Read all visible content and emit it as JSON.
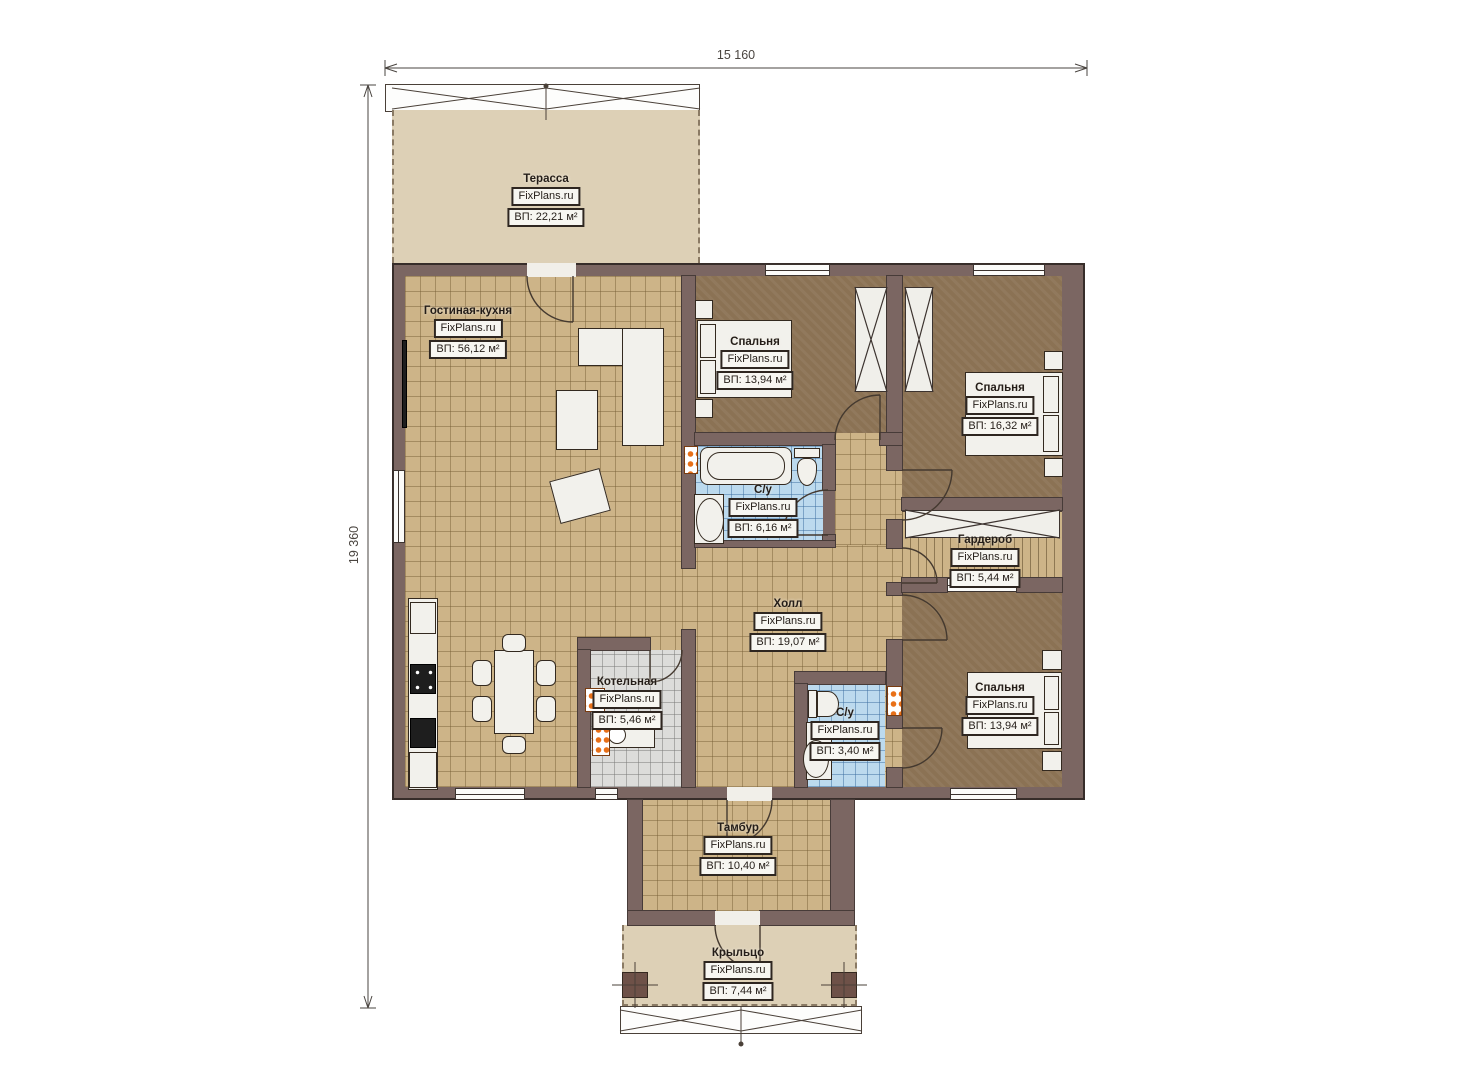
{
  "meta": {
    "brand": "FixPlans.ru"
  },
  "dimensions": {
    "width_label": "15 160",
    "height_label": "19 360"
  },
  "rooms": [
    {
      "id": "terrace",
      "name": "Терасса",
      "area": "ВП: 22,21 м²"
    },
    {
      "id": "living-kitchen",
      "name": "Гостиная-кухня",
      "area": "ВП: 56,12 м²"
    },
    {
      "id": "bedroom-1",
      "name": "Спальня",
      "area": "ВП: 13,94 м²"
    },
    {
      "id": "bedroom-2",
      "name": "Спальня",
      "area": "ВП: 16,32 м²"
    },
    {
      "id": "bathroom-1",
      "name": "С/у",
      "area": "ВП: 6,16 м²"
    },
    {
      "id": "wardrobe",
      "name": "Гардероб",
      "area": "ВП: 5,44 м²"
    },
    {
      "id": "hall",
      "name": "Холл",
      "area": "ВП: 19,07 м²"
    },
    {
      "id": "boiler-room",
      "name": "Котельная",
      "area": "ВП: 5,46 м²"
    },
    {
      "id": "bathroom-2",
      "name": "С/у",
      "area": "ВП: 3,40 м²"
    },
    {
      "id": "bedroom-3",
      "name": "Спальня",
      "area": "ВП: 13,94 м²"
    },
    {
      "id": "vestibule",
      "name": "Тамбур",
      "area": "ВП: 10,40 м²"
    },
    {
      "id": "porch",
      "name": "Крыльцо",
      "area": "ВП: 7,44 м²"
    }
  ],
  "colors": {
    "wall": "#7b6662",
    "tile": "#cdb488",
    "bedroom_floor": "#8b7254",
    "bath_tile": "#bcdaee",
    "terrace": "#ddd0b6",
    "radiator": "#e87018"
  }
}
